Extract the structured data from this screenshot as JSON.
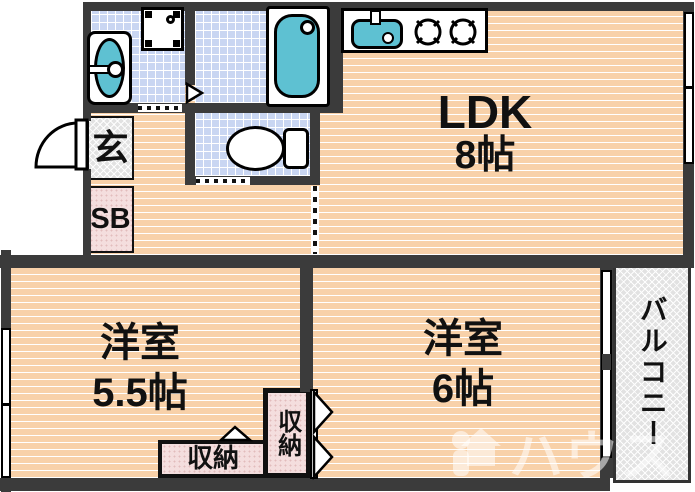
{
  "plan_type": "japanese-apartment-floorplan",
  "rooms": {
    "ldk": {
      "name": "LDK",
      "size": "8帖"
    },
    "west55": {
      "name": "洋室",
      "size": "5.5帖"
    },
    "west6": {
      "name": "洋室",
      "size": "6帖"
    },
    "entrance": {
      "label": "玄"
    },
    "shoebox": {
      "label": "SB"
    },
    "closet_main": {
      "label": "収納"
    },
    "closet_side": {
      "label": "収納"
    },
    "balcony": {
      "label": "バルコニー"
    }
  },
  "fixtures": [
    "bathtub",
    "washbasin",
    "washing-machine-pan",
    "toilet",
    "kitchen-sink",
    "gas-stove",
    "entrance-door"
  ],
  "watermark": {
    "brand": "ハウス"
  },
  "colors": {
    "wall": "#3b3b3b",
    "wood_floor": "#f8d1a9",
    "tile_floor": "#c9d6f2",
    "fixture_teal": "#5ec1d2",
    "closet_pink": "#f4dede",
    "hatch_gray": "#e2e2e2"
  }
}
